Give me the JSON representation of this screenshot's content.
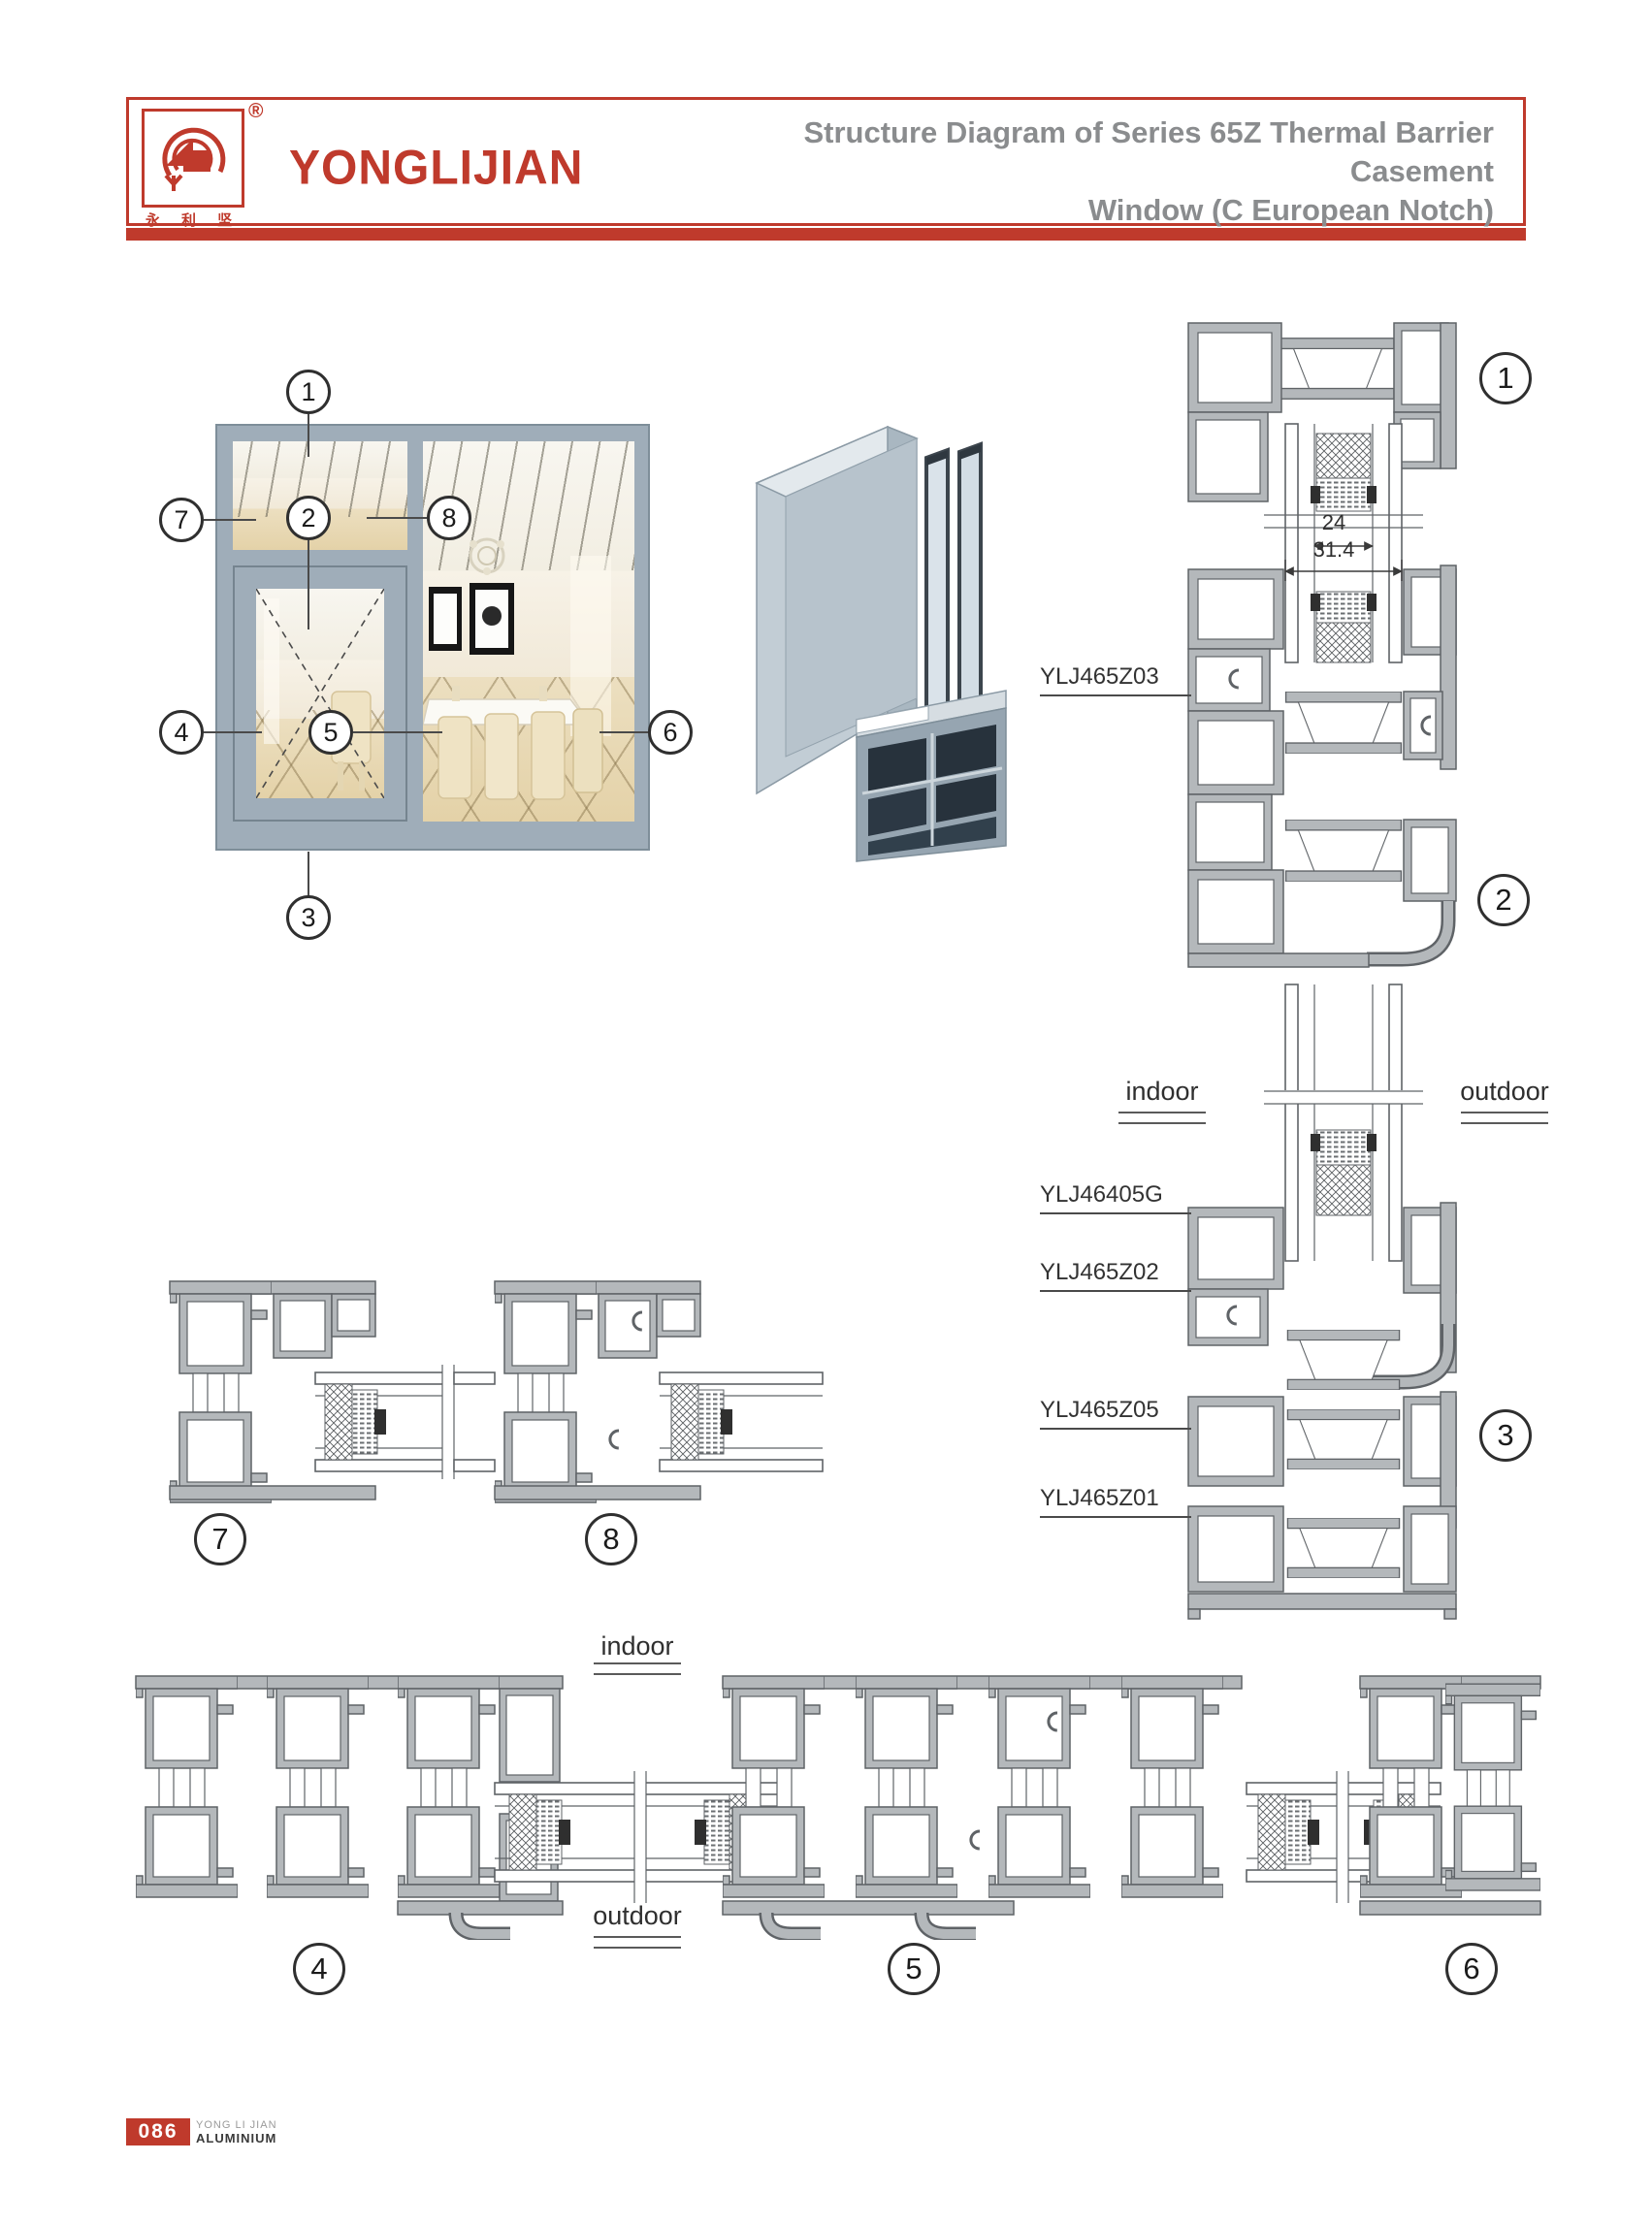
{
  "header": {
    "registered_mark": "®",
    "brand": "YONGLIJIAN",
    "brand_chinese": "永 利 坚",
    "title_line1": "Structure Diagram of Series 65Z Thermal Barrier Casement",
    "title_line2": "Window (C European Notch)"
  },
  "callouts": {
    "c1": "1",
    "c2": "2",
    "c3": "3",
    "c4": "4",
    "c5": "5",
    "c6": "6",
    "c7": "7",
    "c8": "8"
  },
  "diagram": {
    "dim_glass_unit": "24",
    "dim_overall": "31.4",
    "profile_labels": {
      "z03": "YLJ465Z03",
      "g05": "YLJ46405G",
      "z02": "YLJ465Z02",
      "z05": "YLJ465Z05",
      "z01": "YLJ465Z01"
    },
    "indoor": "indoor",
    "outdoor": "outdoor"
  },
  "footer": {
    "page_number": "086",
    "company_line1": "YONG LI JIAN",
    "company_line2": "ALUMINIUM"
  },
  "colors": {
    "accent_red": "#bf3a2c",
    "title_gray": "#8a8c8e",
    "drawing_line": "#5f6367",
    "window_frame": "#9fadb9"
  }
}
